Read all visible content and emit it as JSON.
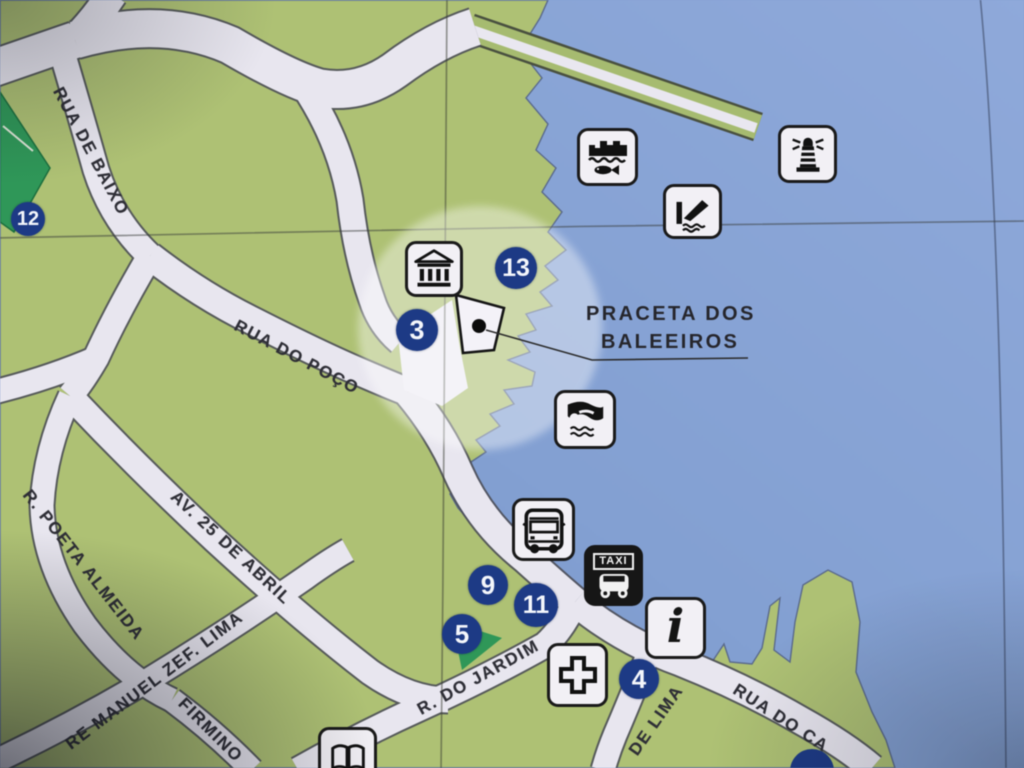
{
  "place_label": {
    "line1": "PRACETA DOS",
    "line2": "BALEEIROS"
  },
  "streets": [
    {
      "id": "rua-de-baixo",
      "name": "RUA DE BAIXO"
    },
    {
      "id": "rua-do-poco",
      "name": "RUA DO POÇO"
    },
    {
      "id": "av-25-de-abril",
      "name": "AV. 25 DE ABRIL"
    },
    {
      "id": "r-poeta-almeida",
      "name": "R. POETA ALMEIDA"
    },
    {
      "id": "manuel-zef-lima",
      "name": "RE MANUEL ZEF. LIMA"
    },
    {
      "id": "firmino",
      "name": "FIRMINO"
    },
    {
      "id": "r-do-jardim",
      "name": "R. DO JARDIM"
    },
    {
      "id": "de-lima",
      "name": "DE LIMA"
    },
    {
      "id": "rua-do-ca",
      "name": "RUA DO CA"
    }
  ],
  "markers": [
    {
      "number": "12"
    },
    {
      "number": "13"
    },
    {
      "number": "3"
    },
    {
      "number": "9"
    },
    {
      "number": "11"
    },
    {
      "number": "5"
    },
    {
      "number": "4"
    }
  ],
  "icons": {
    "taxi_label": "TAXI",
    "info_glyph": "i",
    "names": [
      "fort-and-fish",
      "boat-ramp",
      "lighthouse",
      "museum",
      "swimming",
      "bus",
      "taxi",
      "info",
      "first-aid-cross",
      "book"
    ]
  },
  "colors": {
    "water": "#84a0d2",
    "land": "#aec174",
    "park": "#2f9758",
    "road": "#e8e6ef",
    "marker_blue": "#1d3a85",
    "highlight": "#ffffff"
  }
}
